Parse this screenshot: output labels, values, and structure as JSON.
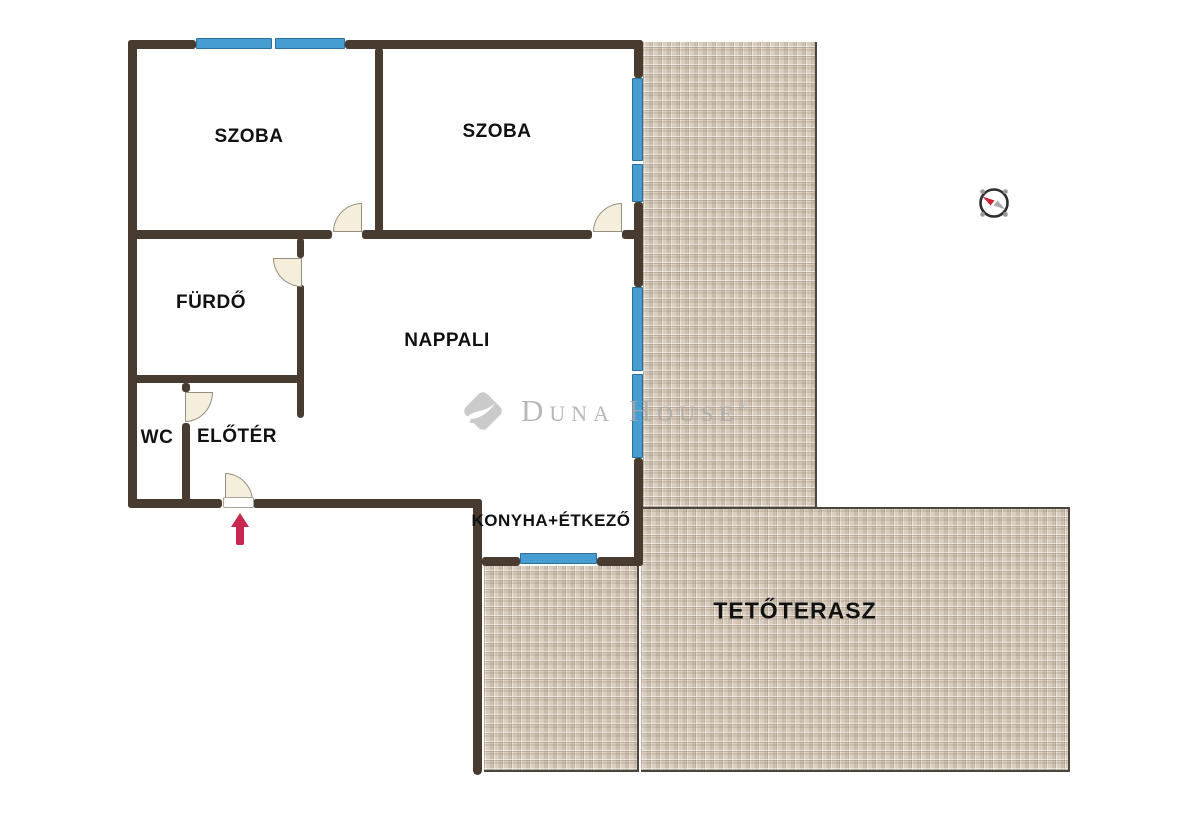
{
  "plan": {
    "type": "apartment-floor-plan",
    "rooms": {
      "szoba1": {
        "label": "SZOBA"
      },
      "szoba2": {
        "label": "SZOBA"
      },
      "furdo": {
        "label": "FÜRDŐ"
      },
      "nappali": {
        "label": "NAPPALI"
      },
      "wc": {
        "label": "WC"
      },
      "eloter": {
        "label": "ELŐTÉR"
      },
      "konyha": {
        "label": "KONYHA+ÉTKEZŐ"
      },
      "terasz": {
        "label": "TETŐTERASZ"
      }
    },
    "features": {
      "windows": 7,
      "doors": 5,
      "entrance_arrow": "up-arrow",
      "compass": "compass-rose-needle-northwest"
    },
    "colors": {
      "wall": "#493b30",
      "window": "#459dd2",
      "door_leaf": "#f6eedd",
      "tile": "#d8cdbf",
      "tile_line": "#7d6852",
      "entrance_arrow": "#c7274f",
      "watermark": "#a8a8a8",
      "label_text": "#111111",
      "background": "#ffffff"
    }
  },
  "watermark": {
    "brand": "Duna House",
    "registered": "®"
  }
}
